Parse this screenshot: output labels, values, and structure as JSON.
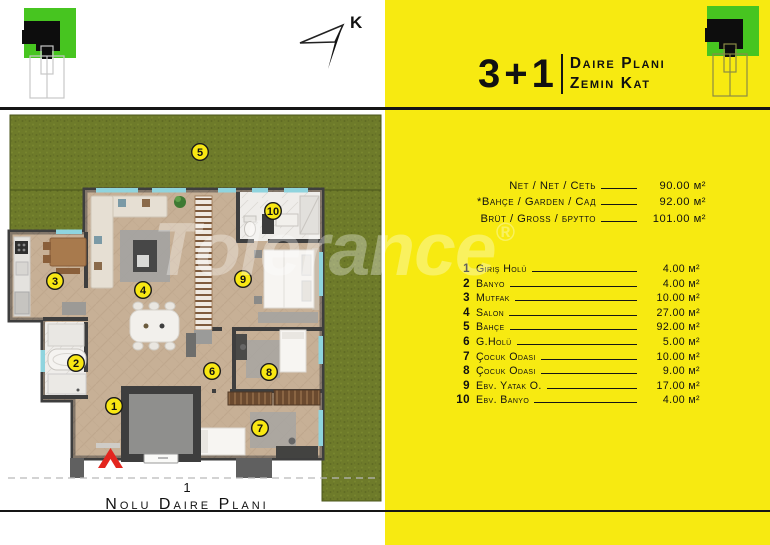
{
  "header": {
    "type": "3+1",
    "title_line1": "Daire Planı",
    "title_line2": "Zemin Kat"
  },
  "north_label": "K",
  "watermark": {
    "text": "Tolerance",
    "reg": "®"
  },
  "areas": {
    "rows": [
      {
        "label": "Net / Net / Сеть",
        "value": "90.00 м²"
      },
      {
        "label": "*Bahçe / Garden / Сад",
        "value": "92.00 м²"
      },
      {
        "label": "Brüt / Gross / брутто",
        "value": "101.00 м²"
      }
    ]
  },
  "room_list": [
    {
      "no": "1",
      "label": "Giriş Holü",
      "value": "4.00 м²"
    },
    {
      "no": "2",
      "label": "Banyo",
      "value": "4.00 м²"
    },
    {
      "no": "3",
      "label": "Mutfak",
      "value": "10.00 м²"
    },
    {
      "no": "4",
      "label": "Salon",
      "value": "27.00 м²"
    },
    {
      "no": "5",
      "label": "Bahçe",
      "value": "92.00 м²"
    },
    {
      "no": "6",
      "label": "G.Holü",
      "value": "5.00 м²"
    },
    {
      "no": "7",
      "label": "Çocuk Odası",
      "value": "10.00 м²"
    },
    {
      "no": "8",
      "label": "Çocuk Odası",
      "value": "9.00 м²"
    },
    {
      "no": "9",
      "label": "Ebv. Yatak O.",
      "value": "17.00 м²"
    },
    {
      "no": "10",
      "label": "Ebv. Banyo",
      "value": "4.00 м²"
    }
  ],
  "plan": {
    "badges": [
      "1",
      "2",
      "3",
      "4",
      "5",
      "6",
      "7",
      "8",
      "9",
      "10"
    ],
    "caption_no": "1",
    "caption": "Nolu Daire Planı"
  },
  "colors": {
    "panel_yellow": "#F7EA11",
    "logo_green": "#47C520",
    "grass_green": "#6E7B2A",
    "wall_gray": "#3E3E3E",
    "wood_floor": "#C7B096",
    "window_teal": "#8FD4DE",
    "badge_yellow": "#F8E713",
    "entry_arrow_red": "#E3251E"
  }
}
